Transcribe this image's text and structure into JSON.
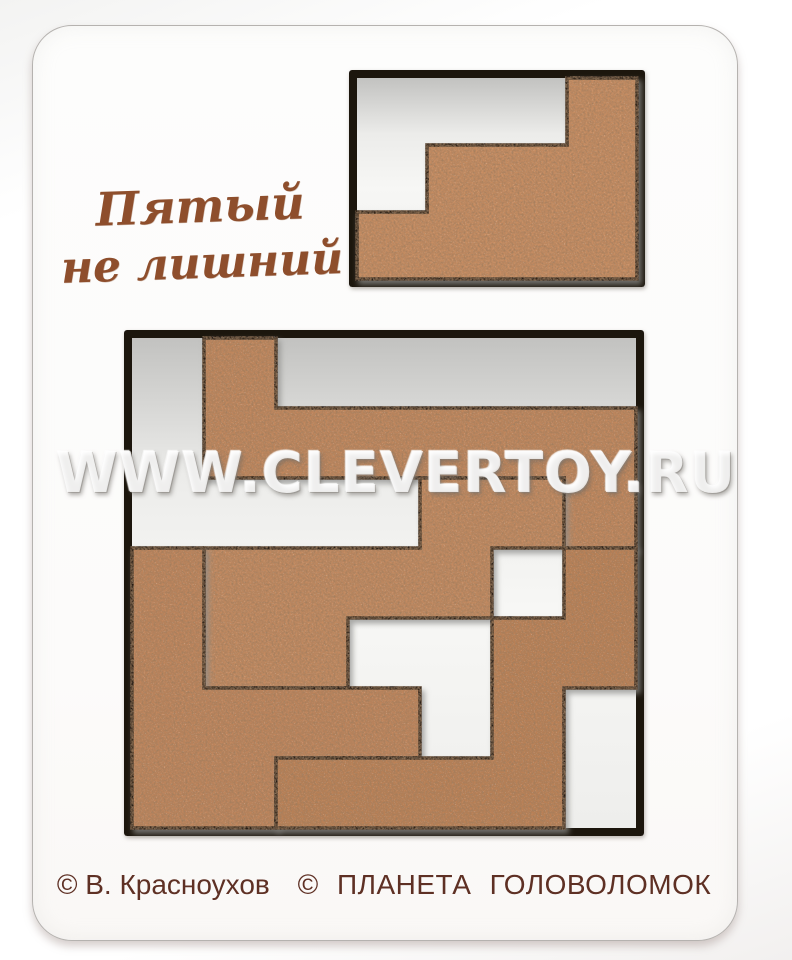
{
  "photo": {
    "title": {
      "line1": "Пятый",
      "line2": "не лишний"
    },
    "watermark": "WWW.CLEVERTOY.RU",
    "copyright": {
      "author": "© В. Красноухов",
      "publisher": "© ПЛАНЕТА ГОЛОВОЛОМОК"
    },
    "colors": {
      "board": "#fcfcfb",
      "frame": "#1d150e",
      "recess_shadow": "#c2c2c0",
      "recess_light": "#f7f7f5",
      "wood_base": "#c2885e",
      "wood_speckle_dark": "#54341c",
      "wood_speckle_light": "#eec9a0",
      "title_text": "#8e4e2c",
      "copyright_text": "#5e3024",
      "cut_line": "#261c12"
    },
    "puzzle": {
      "big_tray": {
        "outer": [
          124,
          330,
          520,
          506
        ],
        "border": 8,
        "grid": [
          7,
          7
        ],
        "pieces": [
          {
            "name": "piece-top-L",
            "fill": "#c1875d",
            "polygon": [
              [
                1,
                0
              ],
              [
                2,
                0
              ],
              [
                2,
                1
              ],
              [
                7,
                1
              ],
              [
                7,
                3
              ],
              [
                6,
                3
              ],
              [
                6,
                2
              ],
              [
                1,
                2
              ]
            ]
          },
          {
            "name": "piece-middle-Z",
            "fill": "#c38a60",
            "polygon": [
              [
                4,
                2
              ],
              [
                6,
                2
              ],
              [
                6,
                3
              ],
              [
                5,
                3
              ],
              [
                5,
                4
              ],
              [
                3,
                4
              ],
              [
                3,
                5
              ],
              [
                1,
                5
              ],
              [
                1,
                3
              ],
              [
                4,
                3
              ]
            ]
          },
          {
            "name": "piece-left-L",
            "fill": "#bf855b",
            "polygon": [
              [
                0,
                3
              ],
              [
                1,
                3
              ],
              [
                1,
                5
              ],
              [
                4,
                5
              ],
              [
                4,
                6
              ],
              [
                2,
                6
              ],
              [
                2,
                7
              ],
              [
                0,
                7
              ]
            ]
          },
          {
            "name": "piece-bottom-right-S",
            "fill": "#bb8157",
            "polygon": [
              [
                6,
                3
              ],
              [
                7,
                3
              ],
              [
                7,
                5
              ],
              [
                6,
                5
              ],
              [
                6,
                7
              ],
              [
                2,
                7
              ],
              [
                2,
                6
              ],
              [
                5,
                6
              ],
              [
                5,
                4
              ],
              [
                6,
                4
              ]
            ]
          }
        ]
      },
      "small_tray": {
        "outer": [
          349,
          70,
          296,
          217
        ],
        "border": 8,
        "grid": [
          4,
          3
        ],
        "pieces": [
          {
            "name": "piece-fifth",
            "fill": "#c78d62",
            "polygon": [
              [
                3,
                0
              ],
              [
                4,
                0
              ],
              [
                4,
                3
              ],
              [
                0,
                3
              ],
              [
                0,
                2
              ],
              [
                1,
                2
              ],
              [
                1,
                1
              ],
              [
                3,
                1
              ]
            ]
          }
        ]
      }
    }
  }
}
